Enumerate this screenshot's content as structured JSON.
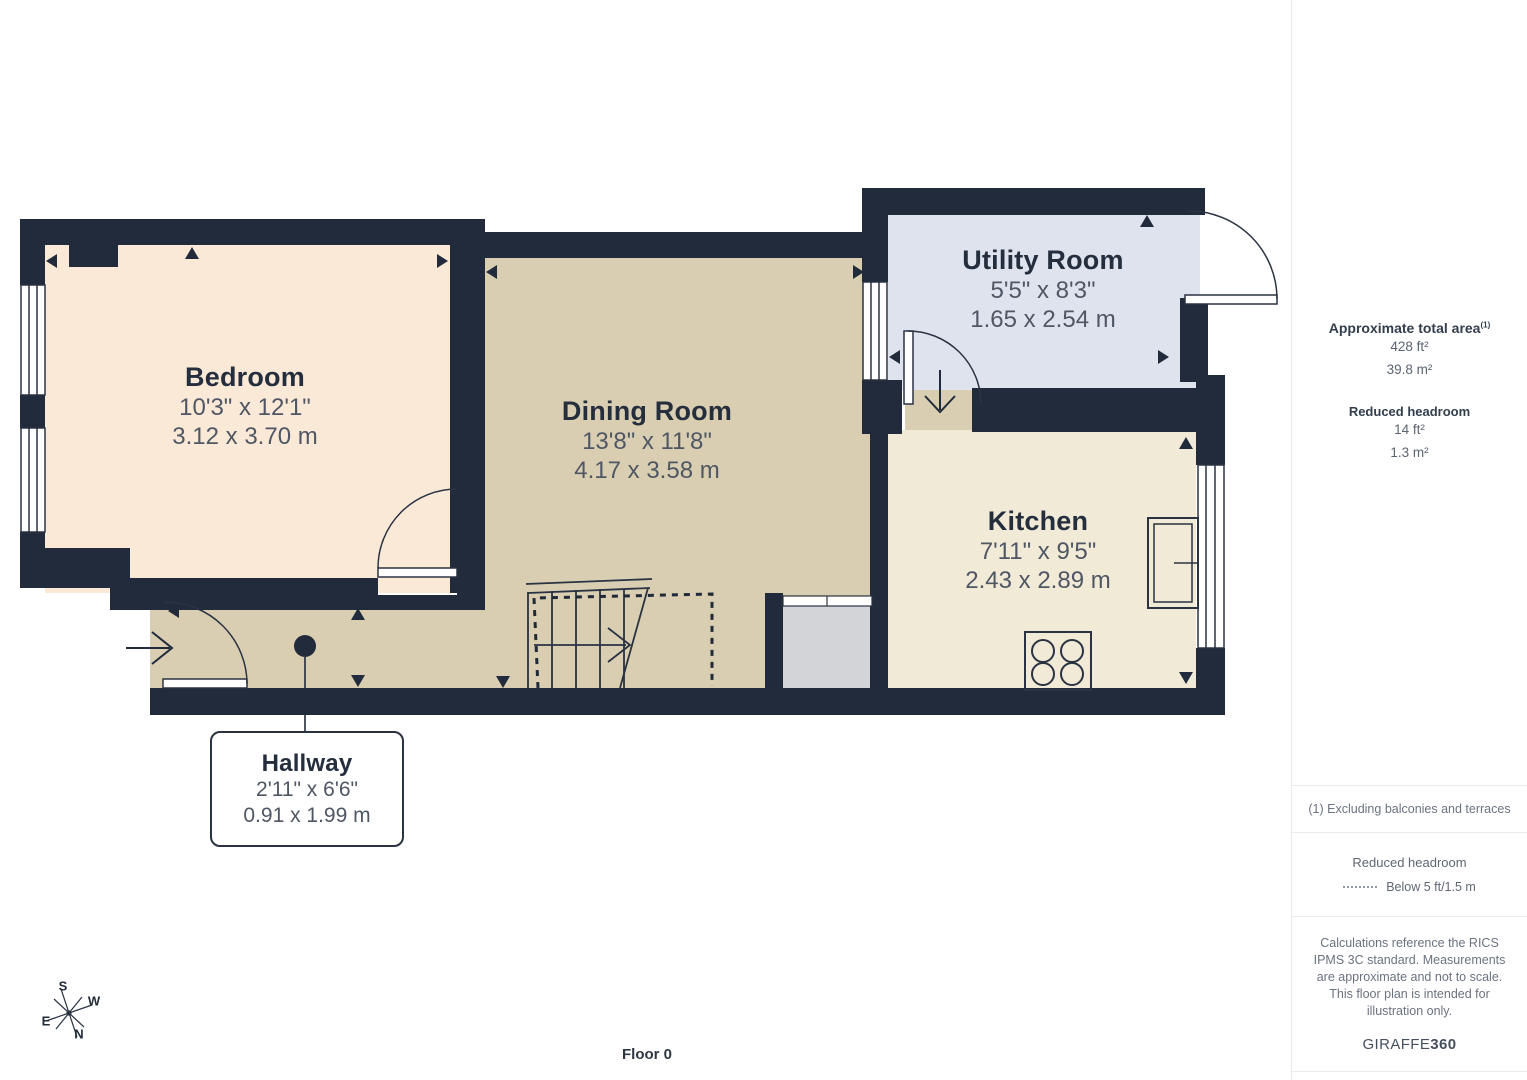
{
  "plan": {
    "floor_label": "Floor 0",
    "rooms": [
      {
        "name": "Bedroom",
        "dim_imperial": "10'3\" x 12'1\"",
        "dim_metric": "3.12 x 3.70 m"
      },
      {
        "name": "Dining Room",
        "dim_imperial": "13'8\" x 11'8\"",
        "dim_metric": "4.17 x 3.58 m"
      },
      {
        "name": "Utility Room",
        "dim_imperial": "5'5\" x 8'3\"",
        "dim_metric": "1.65 x 2.54 m"
      },
      {
        "name": "Kitchen",
        "dim_imperial": "7'11\" x 9'5\"",
        "dim_metric": "2.43 x 2.89 m"
      },
      {
        "name": "Hallway",
        "dim_imperial": "2'11\" x 6'6\"",
        "dim_metric": "0.91 x 1.99 m"
      }
    ],
    "compass": {
      "n": "N",
      "s": "S",
      "e": "E",
      "w": "W"
    }
  },
  "sidebar": {
    "total_area": {
      "title": "Approximate total area",
      "footnote_marker": "(1)",
      "imperial": "428 ft²",
      "metric": "39.8 m²"
    },
    "reduced_headroom": {
      "title": "Reduced headroom",
      "imperial": "14 ft²",
      "metric": "1.3 m²"
    },
    "footnote": "(1) Excluding balconies and terraces",
    "legend": {
      "title": "Reduced headroom",
      "entry": "Below 5 ft/1.5 m"
    },
    "disclaimer": "Calculations reference the RICS IPMS 3C standard. Measurements are approximate and not to scale. This floor plan is intended for illustration only.",
    "brand": {
      "name": "GIRAFFE",
      "suffix": "360"
    }
  },
  "colors": {
    "wall": "#212b3b",
    "line": "#2a3342",
    "bedroom_fill": "#fbe9d8",
    "dining_hallway_fill": "#d9ceb1",
    "utility_fill": "#dfe3ee",
    "kitchen_fill": "#f1ead6",
    "cupboard_fill": "#d3d4d8",
    "room_name_text": "#242e3d",
    "dimension_text": "#4f5764",
    "sidebar_note_text": "#6b7280"
  }
}
